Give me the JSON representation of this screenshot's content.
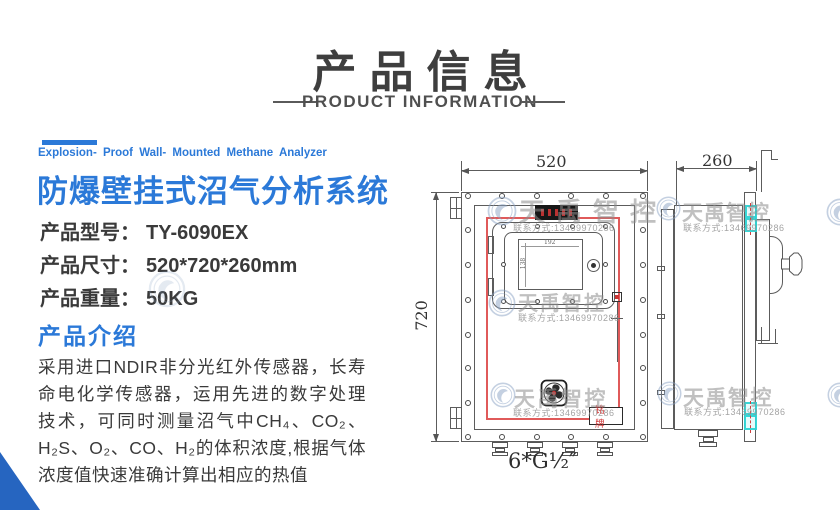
{
  "header": {
    "title": "产品信息",
    "subtitle": "PRODUCT INFORMATION"
  },
  "hero": {
    "tagline_en": "Explosion- Proof  Wall- Mounted  Methane  Analyzer",
    "title_zh": "防爆壁挂式沼气分析系统"
  },
  "specs": {
    "model_label": "产品型号：",
    "model_value": "TY-6090EX",
    "size_label": "产品尺寸：",
    "size_value": "520*720*260mm",
    "weight_label": "产品重量：",
    "weight_value": "50KG"
  },
  "intro": {
    "heading": "产品介绍",
    "lines": [
      "采用进口NDIR非分光红外传感器，长寿",
      "命电化学传感器，运用先进的数字处理",
      "技术，可同时测量沼气中CH₄、CO₂、",
      "H₂S、O₂、CO、H₂的体积浓度,根据气体",
      "浓度值快速准确计算出相应的热值"
    ]
  },
  "drawing": {
    "front": {
      "width_dim": "520",
      "height_dim": "720",
      "screen_width_dim": "192",
      "screen_height_dim": "138",
      "nameplate_label": "铭牌",
      "gland_spec": "6*G½″"
    },
    "side": {
      "depth_dim": "260"
    }
  },
  "watermark": {
    "brand": "天禹智控",
    "contact": "联系方式:13469970286"
  },
  "colors": {
    "accent_blue": "#2b79d8",
    "triangle_blue": "#2665c0",
    "heading_gray": "#3e3e3e",
    "drawing_line": "#5c5c5c",
    "red_outline": "#e05a5a",
    "cyan_highlight": "#2dd4d4",
    "nameplate_red": "#d03030"
  }
}
